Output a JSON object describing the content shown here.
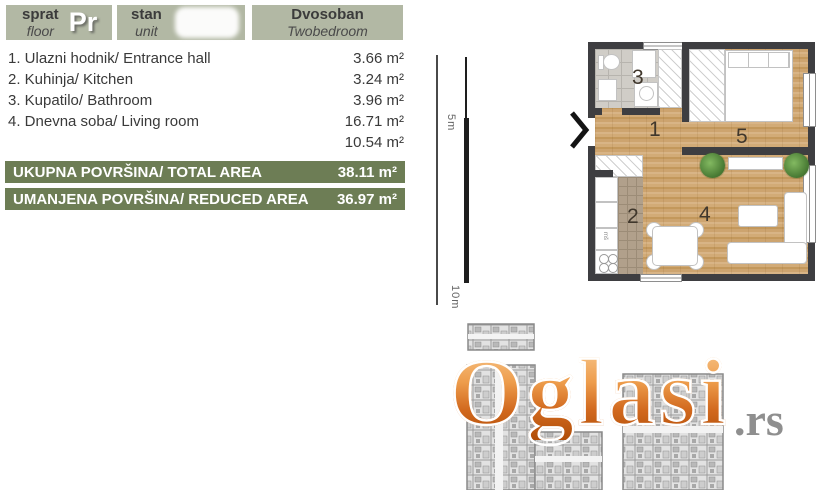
{
  "header": {
    "cells": [
      {
        "sr": "sprat",
        "en": "floor",
        "value": "Pr"
      },
      {
        "sr": "stan",
        "en": "unit",
        "value": ""
      },
      {
        "sr": "Dvosoban",
        "en": "Twobedroom",
        "value": ""
      }
    ]
  },
  "room_list": [
    {
      "label": "1. Ulazni hodnik/ Entrance hall",
      "area": "3.66 m²"
    },
    {
      "label": "2. Kuhinja/ Kitchen",
      "area": "3.24 m²"
    },
    {
      "label": "3. Kupatilo/ Bathroom",
      "area": "3.96 m²"
    },
    {
      "label": "4. Dnevna soba/ Living room",
      "area": "16.71 m²"
    },
    {
      "label": "",
      "area": "10.54 m²"
    }
  ],
  "totals": [
    {
      "label": "UKUPNA POVRŠINA/ TOTAL AREA",
      "value": "38.11 m²"
    },
    {
      "label": "UMANJENA POVRŠINA/ REDUCED AREA",
      "value": "36.97 m²"
    }
  ],
  "scale_bar": {
    "mid_label": "5m",
    "end_label": "10m"
  },
  "floor_plan": {
    "numbers": {
      "entrance_hall": "1",
      "kitchen": "2",
      "bathroom": "3",
      "living_room": "4",
      "bedroom": "5"
    },
    "kitchen_unit_label": "mš"
  },
  "watermark": {
    "brand": "Oglasi",
    "tld": ".rs"
  },
  "colors": {
    "header_bg": "#b2b8a4",
    "bar_green": "#6d7d55",
    "wall": "#3e3e41",
    "wood": "#cda46f",
    "watermark_orange": "#d2691e",
    "watermark_gray": "#8f8f8f"
  }
}
